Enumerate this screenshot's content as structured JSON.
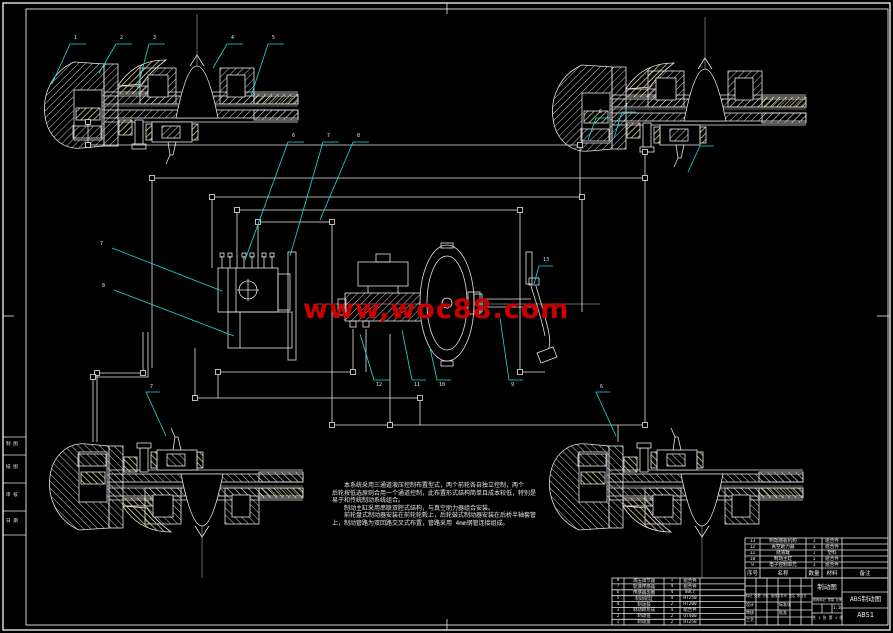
{
  "watermark": {
    "text": "www,woc88.com",
    "color": "#c80000"
  },
  "notes": {
    "lines": [
      "　　本系统采用三通道液压控制布置型式，两个前轮各自独立控制，两个",
      "后轮按低选原则合用一个通道控制，此布置形式结构简单且成本较低，特别是",
      "易于和传统制动系统组合。",
      "　　制动主缸采用串联双腔式结构，与真空助力器组合安装。",
      "　　前轮盘式制动器安装在前轮轮毂上，后轮鼓式制动器安装在后桥半轴套管",
      "上，制动管路为双回路交叉式布置，管路采用 4mm钢管连接组成。"
    ]
  },
  "callouts": {
    "top_left": [
      "1",
      "2",
      "3",
      "4",
      "5"
    ],
    "top_center": [
      "6",
      "7",
      "8"
    ],
    "left_side": [
      "7",
      "8"
    ],
    "bottom_center": [
      "12",
      "11",
      "10",
      "9"
    ],
    "pedal": "13",
    "top_right": [
      "6",
      "7"
    ],
    "bottom_left": "7",
    "bottom_right": "6"
  },
  "bom_right": {
    "header": [
      "序号",
      "名称",
      "数量",
      "材料",
      "备注"
    ],
    "rows": [
      [
        "13",
        "制动踏板机构",
        "1",
        "组合件"
      ],
      [
        "12",
        "真空助力器",
        "1",
        "组合件"
      ],
      [
        "11",
        "储液罐",
        "1",
        "塑料"
      ],
      [
        "10",
        "制动主缸",
        "1",
        "组合件"
      ],
      [
        "9",
        "电子控制单元",
        "1",
        "组合件"
      ]
    ]
  },
  "bom_left": {
    "rows": [
      [
        "8",
        "液压调节器",
        "1",
        "组合件"
      ],
      [
        "7",
        "轮速传感器",
        "4",
        "组合件"
      ],
      [
        "6",
        "传感器齿圈",
        "4",
        "40Cr"
      ],
      [
        "5",
        "制动轮缸",
        "4",
        "HT250"
      ],
      [
        "4",
        "制动鼓",
        "2",
        "HT200"
      ],
      [
        "3",
        "制动蹄总成",
        "4",
        "组合件"
      ],
      [
        "2",
        "制动钳",
        "2",
        "QT400"
      ],
      [
        "1",
        "制动盘",
        "2",
        "HT250"
      ]
    ]
  },
  "title_block": {
    "change_header": "标记 处数 分区 更改文件号 签名 年月日",
    "role_design": "设计",
    "role_check": "审核",
    "role_process": "工艺",
    "role_standard": "标准化",
    "role_approve": "批准",
    "stage_header": "阶段标记  重量  比例",
    "scale": "1:10",
    "sheet": "共 1 张 第 1 张",
    "doc_label": "制动图",
    "title": "ABS制动图",
    "drawing_no": "ABS1"
  },
  "margin_strip": {
    "cells": [
      "制 图",
      "描 图",
      "审 核",
      "日 期"
    ]
  },
  "colors": {
    "background": "#000000",
    "line": "#e6e6e6",
    "leader": "#17e0e0",
    "hatch_yellow": "#efe79b",
    "watermark_red": "#c80000"
  }
}
